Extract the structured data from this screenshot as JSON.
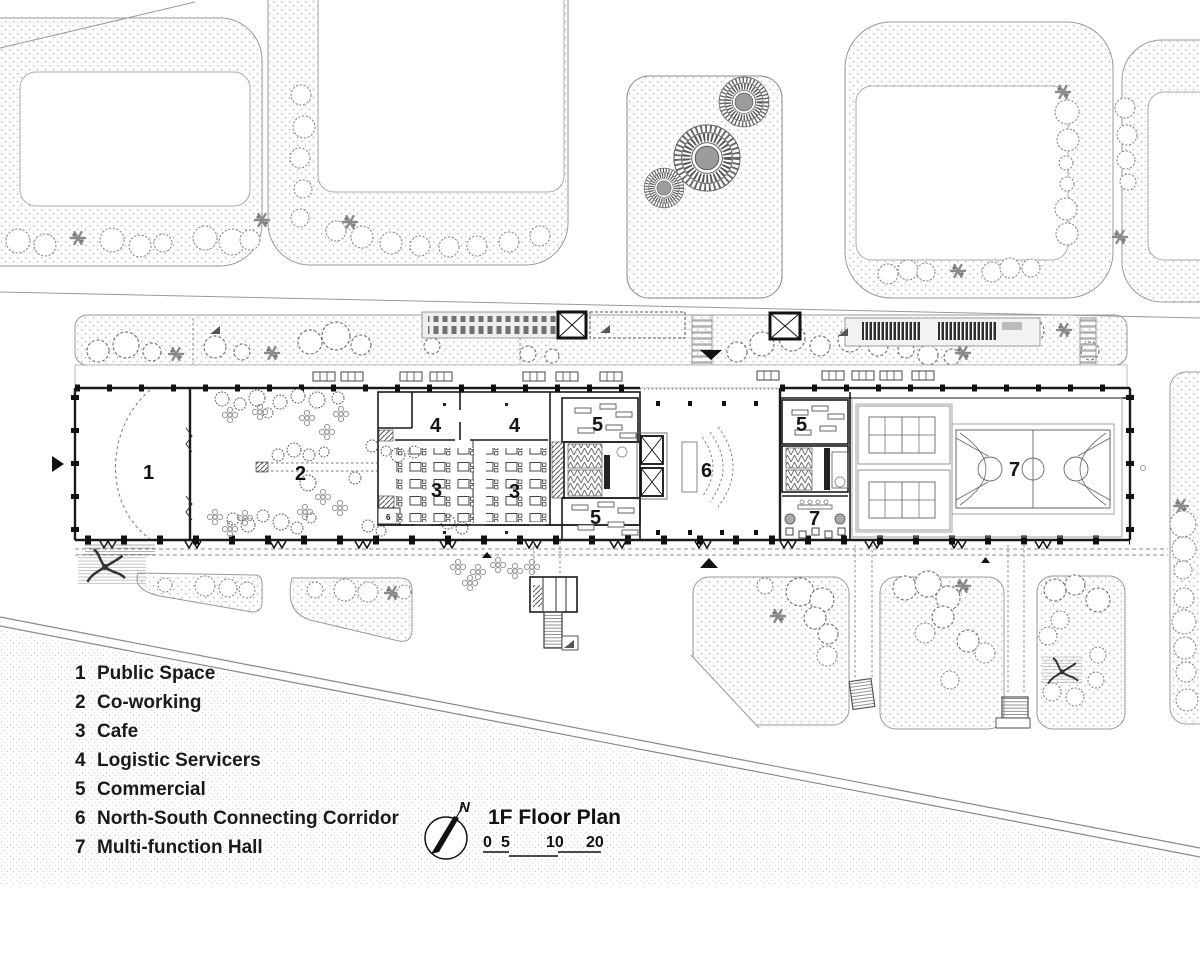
{
  "title_block": {
    "north_label": "N",
    "title": "1F Floor Plan",
    "scale_ticks": [
      "0",
      "5",
      "10",
      "20"
    ]
  },
  "legend": {
    "items": [
      {
        "num": "1",
        "label": "Public Space"
      },
      {
        "num": "2",
        "label": "Co-working"
      },
      {
        "num": "3",
        "label": "Cafe"
      },
      {
        "num": "4",
        "label": "Logistic Servicers"
      },
      {
        "num": "5",
        "label": "Commercial"
      },
      {
        "num": "6",
        "label": "North-South Connecting Corridor"
      },
      {
        "num": "7",
        "label": "Multi-function Hall"
      }
    ]
  },
  "plan": {
    "labels": {
      "n1": "1",
      "n2": "2",
      "n3": "3",
      "n4": "4",
      "n5": "5",
      "n6": "6",
      "n7": "7"
    }
  }
}
